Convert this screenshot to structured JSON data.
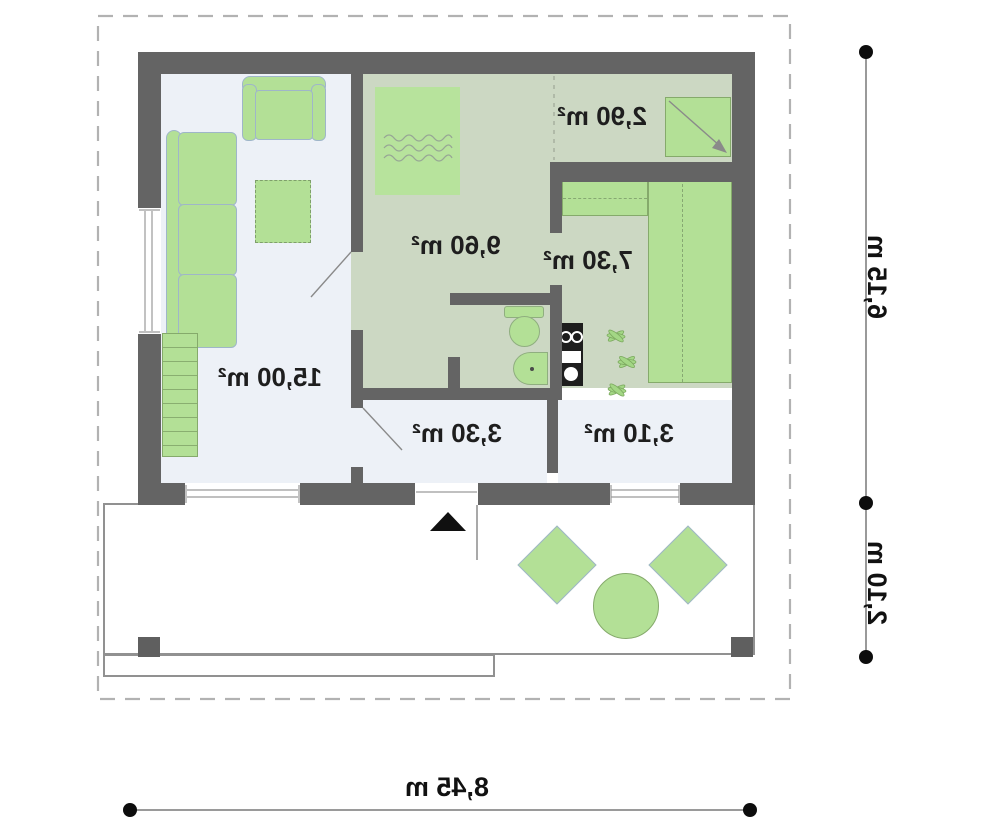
{
  "plan": {
    "type": "floor-plan",
    "mirrored_text": true,
    "rooms": [
      {
        "id": "living-room",
        "area_label": "15,00 m²"
      },
      {
        "id": "bedroom",
        "area_label": "9,60 m²"
      },
      {
        "id": "wardrobe-nook",
        "area_label": "2,90 m²"
      },
      {
        "id": "kitchen-room",
        "area_label": "7,30 m²"
      },
      {
        "id": "entry-hall",
        "area_label": "3,30 m²"
      },
      {
        "id": "bathroom-room",
        "area_label": "3,10 m²"
      }
    ],
    "dimensions": {
      "right_upper": "6,15 m",
      "right_lower": "2,10 m",
      "bottom": "8,45 m"
    },
    "colors": {
      "wall": "#646464",
      "floor_light": "#edf1f7",
      "floor_green": "#ccd8c3",
      "furniture_green": "#b3e096",
      "furniture_border_blue": "#9fb6c9",
      "furniture_border_green": "#85aa6b",
      "dimension_line": "#9a9a9a",
      "boundary_dash": "#b2b2b2",
      "label_text": "#1e1e1e"
    }
  }
}
